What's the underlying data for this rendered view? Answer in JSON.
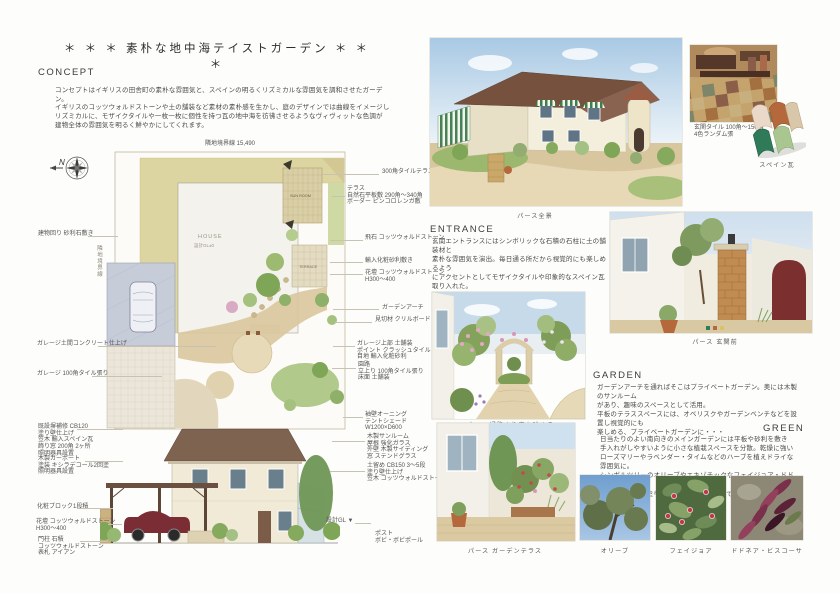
{
  "title": "＊ ＊ ＊  素朴な地中海テイストガーデン  ＊ ＊ ＊",
  "sections": {
    "concept": {
      "heading": "CONCEPT",
      "para1": "コンセプトはイギリスの田舎町の素朴な雰囲気と、スペインの明るくリズミカルな雰囲気を調和させたガーデン。",
      "para2": "イギリスのコッツウォルドストーンや土の舗装など素材の素朴感を生かし、庭のデザインでは曲線をイメージし\nリズミカルに、モザイクタイルや一枚一枚に個性を持つ瓦の地中海を彷彿させるようなヴィヴィットな色調が\n建物全体の雰囲気を明るく鮮やかにしてくれます。"
    },
    "entrance": {
      "heading": "ENTRANCE",
      "para": "玄関エントランスにはシンボリックな石積の石柱に土の舗装材と\n素朴な雰囲気を演出。毎日通る所だから視覚的にも楽しめるよう\nにアクセントとしてモザイクタイルや印象的なスペイン瓦取り入れた。"
    },
    "garden": {
      "heading": "GARDEN",
      "para": "ガーデンアーチを通ればそこはプライベートガーデン。奥には木製のサンルーム\nがあり、趣味のスペースとして活用。\n平板のテラススペースには、オベリスクやガーデンベンチなどを設置し視覚的にも\n楽しめる、プライベートガーデンに・・・"
    },
    "green": {
      "heading": "GREEN",
      "para": "日当たりのよい南向きのメインガーデンには平板や砂利を敷き\n手入れがしやすいように小さな植栽スペースを分散。乾燥に強い\nローズマリーやラベンダー・タイムなどのハーブを植えドライな雰囲気に。\nシンボルツリーのオリーブやエキゾチックなフェイジョア・ドドネアなどの\nカラーリーフが塗り壁のアクセントになっています。"
    }
  },
  "site_plan": {
    "north_label": "N",
    "boundary_top": "隣地境界線 15,490",
    "boundary_left": "隣地境界線",
    "boundary_right": "隣地境界線",
    "house_label": "HOUSE",
    "house_gl": "設計GL±0",
    "sunroom_label": "SUN ROOM",
    "terrace_label": "TERRACE",
    "annotations_left": [
      "建物回り 砂利石敷き",
      "ガレージ土間コンクリート仕上げ",
      "ガレージ 100角タイル張り"
    ],
    "annotations_right": [
      "300角タイルテラス",
      "テラス\n自然石平板敷 290角〜340角\nボーダー ピンコロレンガ敷",
      "飛石 コッツウォルドストーン",
      "輸入化粧砂利敷き",
      "花壇 コッツウォルドストーン\nH300〜400",
      "ガーデンアーチ",
      "見切材 クリルボード",
      "ガレージ上部 土舗装\nポイント クラッシュタイル\n目地 輸入化粧砂利",
      "園路\n立上り 100角タイル張り\n床面 土舗装"
    ]
  },
  "elevation": {
    "annotations_left": [
      "既設塀補修 CB120\n塗り壁仕上げ\n笠木 輸入スペイン瓦\n飾り窓 200角 2ヶ所\n照明器具設置",
      "木製カーポート\n塗装 キシラデコール2回塗\n照明器具設置",
      "化粧ブロック1段積",
      "花壇 コッツウォルドストーン\nH300〜400",
      "門柱 石積\nコッツウォルドストーン\n表札 アイアン"
    ],
    "annotations_right": [
      "袖壁オーニング\nテントシェード\nW1200×D600",
      "木製サンルーム\n屋根 強化ガラス\n外壁 木製サイディング\n窓 ステンドグラス",
      "土留め CB150 3〜5段\n塗り壁仕上げ\n笠木 コッツウォルドストーン埋込"
    ],
    "gl_label": "設計GL ▼",
    "post_label": "ポスト\nボビ・ボビポール"
  },
  "captions": {
    "main_view": "パース全景",
    "entrance_view": "パース 玄関前",
    "path_view": "パース 通路より庭を眺める",
    "terrace_view": "パース ガーデンテラス",
    "entry_tile": "玄関タイル 100角〜150角\n4色ランダム張",
    "spain_tile": "スペイン瓦"
  },
  "plants": [
    {
      "caption": "オリーブ"
    },
    {
      "caption": "フェイジョア"
    },
    {
      "caption": "ドドネア・ビスコーサ"
    }
  ],
  "colors": {
    "band_khaki": "#ddd5a1",
    "roof_brown": "#7d6350",
    "green": "#85a25c",
    "terracotta": "#b5683c"
  }
}
